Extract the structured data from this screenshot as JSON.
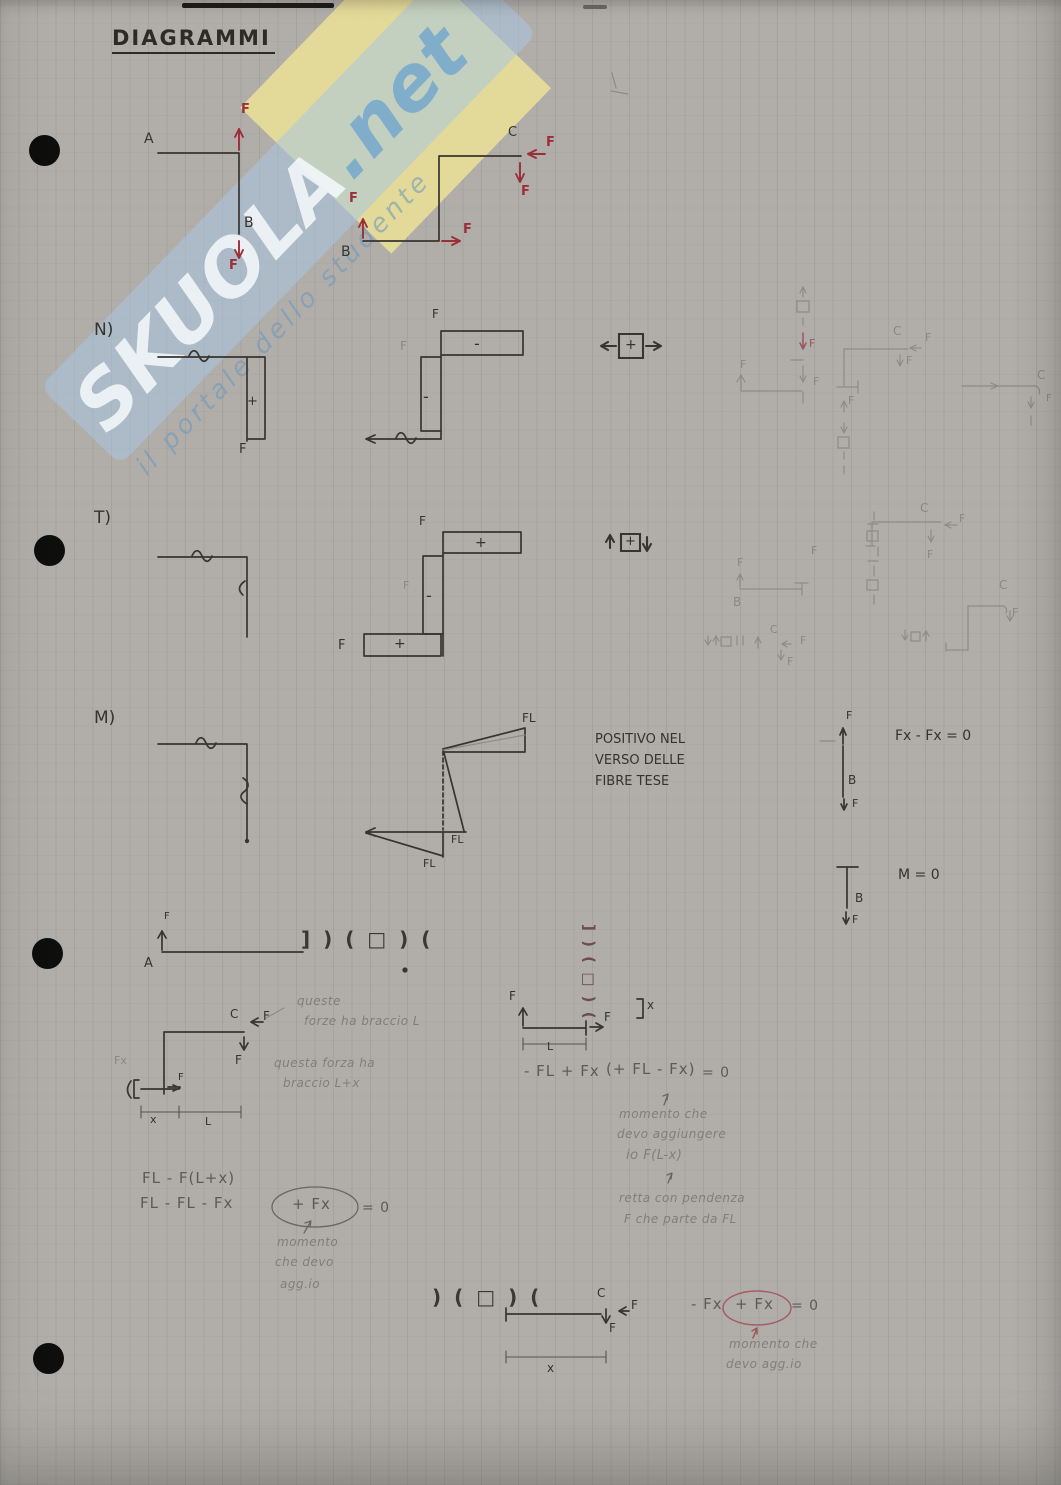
{
  "page": {
    "title": "DIAGRAMMI"
  },
  "watermark": {
    "brand": "SKUOLA",
    "dot": ".",
    "tld": "net",
    "tagline": "il portale dello studente"
  },
  "labels": [
    {
      "t": "A",
      "x": 144,
      "y": 132,
      "c": "ink",
      "s": 14
    },
    {
      "t": "F",
      "x": 241,
      "y": 103,
      "c": "red",
      "s": 13
    },
    {
      "t": "B",
      "x": 244,
      "y": 216,
      "c": "ink",
      "s": 14
    },
    {
      "t": "F",
      "x": 229,
      "y": 259,
      "c": "red",
      "s": 13
    },
    {
      "t": "B",
      "x": 341,
      "y": 245,
      "c": "ink",
      "s": 14
    },
    {
      "t": "F",
      "x": 349,
      "y": 192,
      "c": "red",
      "s": 13
    },
    {
      "t": "F",
      "x": 463,
      "y": 223,
      "c": "red",
      "s": 13
    },
    {
      "t": "C",
      "x": 508,
      "y": 126,
      "c": "ink",
      "s": 13
    },
    {
      "t": "F",
      "x": 546,
      "y": 136,
      "c": "red",
      "s": 13
    },
    {
      "t": "F",
      "x": 521,
      "y": 185,
      "c": "red",
      "s": 13
    },
    {
      "t": "N)",
      "x": 94,
      "y": 322,
      "c": "ink",
      "s": 17
    },
    {
      "t": "+",
      "x": 247,
      "y": 395,
      "c": "ink",
      "s": 13
    },
    {
      "t": "F",
      "x": 239,
      "y": 443,
      "c": "ink",
      "s": 13
    },
    {
      "t": "F",
      "x": 432,
      "y": 308,
      "c": "ink",
      "s": 12
    },
    {
      "t": "-",
      "x": 474,
      "y": 336,
      "c": "ink",
      "s": 16
    },
    {
      "t": "-",
      "x": 423,
      "y": 389,
      "c": "ink",
      "s": 16
    },
    {
      "t": "F",
      "x": 400,
      "y": 340,
      "c": "faint",
      "s": 12
    },
    {
      "t": "+",
      "x": 625,
      "y": 338,
      "c": "ink",
      "s": 14
    },
    {
      "t": "F",
      "x": 809,
      "y": 338,
      "c": "redfaint",
      "s": 11
    },
    {
      "t": "F",
      "x": 813,
      "y": 376,
      "c": "faint",
      "s": 11
    },
    {
      "t": "F",
      "x": 740,
      "y": 359,
      "c": "faint",
      "s": 11
    },
    {
      "t": "C",
      "x": 893,
      "y": 325,
      "c": "faint",
      "s": 12
    },
    {
      "t": "F",
      "x": 925,
      "y": 332,
      "c": "faint",
      "s": 11
    },
    {
      "t": "F",
      "x": 906,
      "y": 355,
      "c": "faint",
      "s": 11
    },
    {
      "t": "F",
      "x": 848,
      "y": 395,
      "c": "faint",
      "s": 11
    },
    {
      "t": "C",
      "x": 1037,
      "y": 369,
      "c": "faint",
      "s": 12
    },
    {
      "t": "F",
      "x": 1046,
      "y": 394,
      "c": "faint",
      "s": 10
    },
    {
      "t": "T)",
      "x": 94,
      "y": 510,
      "c": "ink",
      "s": 17
    },
    {
      "t": "F",
      "x": 419,
      "y": 515,
      "c": "ink",
      "s": 12
    },
    {
      "t": "+",
      "x": 475,
      "y": 536,
      "c": "ink",
      "s": 14
    },
    {
      "t": "-",
      "x": 426,
      "y": 588,
      "c": "ink",
      "s": 16
    },
    {
      "t": "F",
      "x": 403,
      "y": 580,
      "c": "faint",
      "s": 11
    },
    {
      "t": "+",
      "x": 394,
      "y": 637,
      "c": "ink",
      "s": 14
    },
    {
      "t": "F",
      "x": 338,
      "y": 639,
      "c": "ink",
      "s": 13
    },
    {
      "t": "+",
      "x": 625,
      "y": 535,
      "c": "ink",
      "s": 13
    },
    {
      "t": "C",
      "x": 920,
      "y": 502,
      "c": "faint",
      "s": 12
    },
    {
      "t": "F",
      "x": 959,
      "y": 513,
      "c": "faint",
      "s": 11
    },
    {
      "t": "F",
      "x": 927,
      "y": 549,
      "c": "faint",
      "s": 11
    },
    {
      "t": "F",
      "x": 811,
      "y": 545,
      "c": "faint",
      "s": 11
    },
    {
      "t": "B",
      "x": 733,
      "y": 596,
      "c": "faint",
      "s": 12
    },
    {
      "t": "F",
      "x": 737,
      "y": 557,
      "c": "faint",
      "s": 11
    },
    {
      "t": "C",
      "x": 770,
      "y": 624,
      "c": "faint",
      "s": 11
    },
    {
      "t": "F",
      "x": 800,
      "y": 635,
      "c": "faint",
      "s": 11
    },
    {
      "t": "F",
      "x": 787,
      "y": 656,
      "c": "faint",
      "s": 11
    },
    {
      "t": "C",
      "x": 999,
      "y": 579,
      "c": "faint",
      "s": 12
    },
    {
      "t": "F",
      "x": 1012,
      "y": 607,
      "c": "faint",
      "s": 11
    },
    {
      "t": "M)",
      "x": 94,
      "y": 710,
      "c": "ink",
      "s": 17
    },
    {
      "t": "FL",
      "x": 522,
      "y": 712,
      "c": "ink",
      "s": 12
    },
    {
      "t": "FL",
      "x": 451,
      "y": 834,
      "c": "ink",
      "s": 11
    },
    {
      "t": "FL",
      "x": 423,
      "y": 858,
      "c": "ink",
      "s": 11
    },
    {
      "t": "POSITIVO NEL",
      "x": 595,
      "y": 733,
      "c": "ink",
      "s": 13
    },
    {
      "t": "VERSO DELLE",
      "x": 595,
      "y": 754,
      "c": "ink",
      "s": 13
    },
    {
      "t": "FIBRE TESE",
      "x": 595,
      "y": 775,
      "c": "ink",
      "s": 13
    },
    {
      "t": "F",
      "x": 846,
      "y": 710,
      "c": "ink",
      "s": 11
    },
    {
      "t": "B",
      "x": 848,
      "y": 774,
      "c": "ink",
      "s": 12
    },
    {
      "t": "F",
      "x": 852,
      "y": 798,
      "c": "ink",
      "s": 11
    },
    {
      "t": "Fx - Fx = 0",
      "x": 895,
      "y": 729,
      "c": "ink",
      "s": 14
    },
    {
      "t": "B",
      "x": 855,
      "y": 892,
      "c": "ink",
      "s": 12
    },
    {
      "t": "F",
      "x": 852,
      "y": 914,
      "c": "ink",
      "s": 11
    },
    {
      "t": "M = 0",
      "x": 898,
      "y": 868,
      "c": "ink",
      "s": 14
    },
    {
      "t": "F",
      "x": 164,
      "y": 912,
      "c": "ink",
      "s": 10
    },
    {
      "t": "A",
      "x": 144,
      "y": 957,
      "c": "ink",
      "s": 13
    },
    {
      "t": "] ) ( □ ) (",
      "x": 301,
      "y": 929,
      "c": "sym",
      "s": 20
    },
    {
      "t": "C",
      "x": 230,
      "y": 1008,
      "c": "ink",
      "s": 12
    },
    {
      "t": "F",
      "x": 263,
      "y": 1010,
      "c": "ink",
      "s": 12
    },
    {
      "t": "F",
      "x": 235,
      "y": 1054,
      "c": "ink",
      "s": 12
    },
    {
      "t": "Fx",
      "x": 114,
      "y": 1055,
      "c": "faint",
      "s": 11
    },
    {
      "t": "F",
      "x": 178,
      "y": 1073,
      "c": "ink",
      "s": 10
    },
    {
      "t": "x",
      "x": 150,
      "y": 1114,
      "c": "ink",
      "s": 11
    },
    {
      "t": "L",
      "x": 205,
      "y": 1116,
      "c": "ink",
      "s": 11
    },
    {
      "t": "queste",
      "x": 297,
      "y": 995,
      "c": "pencil",
      "s": 12
    },
    {
      "t": "forze ha braccio L",
      "x": 304,
      "y": 1015,
      "c": "pencil",
      "s": 12
    },
    {
      "t": "questa forza ha",
      "x": 274,
      "y": 1057,
      "c": "pencil",
      "s": 12
    },
    {
      "t": "braccio L+x",
      "x": 283,
      "y": 1077,
      "c": "pencil",
      "s": 12
    },
    {
      "t": "FL - F(L+x)",
      "x": 142,
      "y": 1171,
      "c": "eq",
      "s": 15
    },
    {
      "t": "FL - FL - Fx",
      "x": 140,
      "y": 1196,
      "c": "eq",
      "s": 15
    },
    {
      "t": "+ Fx",
      "x": 292,
      "y": 1197,
      "c": "eq",
      "s": 15
    },
    {
      "t": "= 0",
      "x": 362,
      "y": 1201,
      "c": "eq",
      "s": 14
    },
    {
      "t": "momento",
      "x": 277,
      "y": 1236,
      "c": "pencil",
      "s": 12
    },
    {
      "t": "che devo",
      "x": 275,
      "y": 1256,
      "c": "pencil",
      "s": 12
    },
    {
      "t": "agg.io",
      "x": 280,
      "y": 1278,
      "c": "pencil",
      "s": 12
    },
    {
      "t": "] ) ( □ ) (",
      "x": 596,
      "y": 924,
      "c": "symr",
      "s": 15,
      "r": 90
    },
    {
      "t": "F",
      "x": 509,
      "y": 990,
      "c": "ink",
      "s": 12
    },
    {
      "t": "F",
      "x": 604,
      "y": 1011,
      "c": "ink",
      "s": 12
    },
    {
      "t": "L",
      "x": 547,
      "y": 1041,
      "c": "ink",
      "s": 11
    },
    {
      "t": "x",
      "x": 647,
      "y": 999,
      "c": "ink",
      "s": 12
    },
    {
      "t": "- FL + Fx",
      "x": 524,
      "y": 1064,
      "c": "eq",
      "s": 15
    },
    {
      "t": "(+ FL - Fx)",
      "x": 606,
      "y": 1062,
      "c": "eq",
      "s": 15
    },
    {
      "t": "= 0",
      "x": 702,
      "y": 1066,
      "c": "eq",
      "s": 14
    },
    {
      "t": "momento che",
      "x": 619,
      "y": 1108,
      "c": "pencil",
      "s": 12
    },
    {
      "t": "devo aggiungere",
      "x": 617,
      "y": 1128,
      "c": "pencil",
      "s": 12
    },
    {
      "t": "io F(L-x)",
      "x": 626,
      "y": 1149,
      "c": "pencil",
      "s": 13
    },
    {
      "t": "retta con pendenza",
      "x": 619,
      "y": 1192,
      "c": "pencil",
      "s": 12
    },
    {
      "t": "F che parte da FL",
      "x": 624,
      "y": 1213,
      "c": "pencil",
      "s": 12
    },
    {
      "t": ") ( □ ) (",
      "x": 432,
      "y": 1287,
      "c": "sym",
      "s": 20
    },
    {
      "t": "C",
      "x": 597,
      "y": 1287,
      "c": "ink",
      "s": 12
    },
    {
      "t": "F",
      "x": 631,
      "y": 1299,
      "c": "ink",
      "s": 12
    },
    {
      "t": "F",
      "x": 609,
      "y": 1322,
      "c": "ink",
      "s": 12
    },
    {
      "t": "x",
      "x": 547,
      "y": 1362,
      "c": "ink",
      "s": 12
    },
    {
      "t": "- Fx",
      "x": 691,
      "y": 1297,
      "c": "eq",
      "s": 15
    },
    {
      "t": "+ Fx",
      "x": 735,
      "y": 1297,
      "c": "eq",
      "s": 15
    },
    {
      "t": "= 0",
      "x": 791,
      "y": 1299,
      "c": "eq",
      "s": 14
    },
    {
      "t": "momento che",
      "x": 729,
      "y": 1338,
      "c": "pencil",
      "s": 12
    },
    {
      "t": "devo agg.io",
      "x": 726,
      "y": 1358,
      "c": "pencil",
      "s": 12
    }
  ]
}
